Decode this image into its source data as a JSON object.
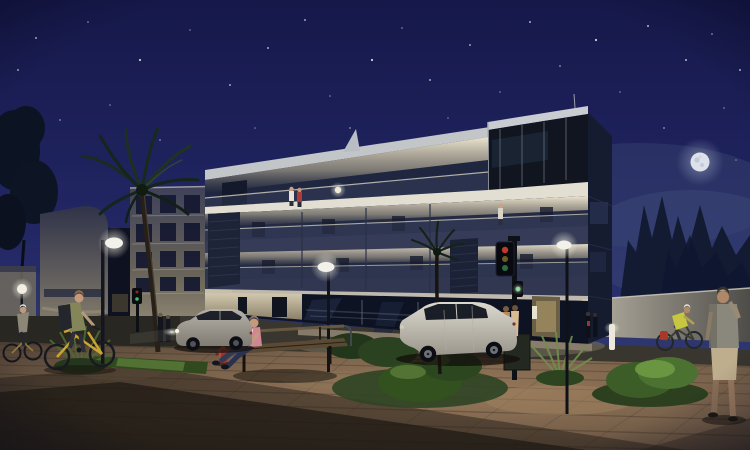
{
  "scene": {
    "description": "Night-time 3D architectural rendering of a modern four-storey apartment building with warmly illuminated balconies, street lamps, traffic light, pedestrians, cyclists, a reading woman on a bench, parked cars and shrubs on a brick-paved plaza under a starry sky with a full moon",
    "time_of_day": "night",
    "objects": [
      "starry sky",
      "full moon",
      "modern apartment building with lit balconies",
      "rooftop terrace with two people",
      "balcony with standing person",
      "glazed penthouse",
      "neighbouring white apartment block",
      "curved corner building",
      "palm trees",
      "street lamps",
      "traffic light",
      "fire hydrant",
      "wooden bench",
      "person reading on bench",
      "silver parked car with headlights on",
      "white parked car",
      "couple standing behind car",
      "cyclists",
      "man walking while phoning",
      "shrubs and ferns",
      "brick-paved plaza with long diagonal shadow",
      "white boundary wall",
      "dark trees behind wall"
    ]
  },
  "palette": {
    "sky_top": "#16184a",
    "sky_mid": "#232866",
    "sky_horizon": "#3b4579",
    "moon": "#dde1ea",
    "facade_white": "#c3c6c9",
    "warm_light": "#f6eed6",
    "slab_dark": "#363c58",
    "glass_dark": "#0d1322",
    "pavement_lit": "#97795b",
    "pavement_dark": "#4f4034",
    "shadow": "#231d18",
    "grass": "#31491f",
    "bush_bright": "#5b7c3a",
    "car_silver": "#b5b2a9",
    "car_white": "#dcd9cf",
    "hydrant_red": "#a43227",
    "bike_yellow": "#c9a42e",
    "wall_white": "#b7b2a4",
    "lamp_glow": "#f3f2ea"
  }
}
